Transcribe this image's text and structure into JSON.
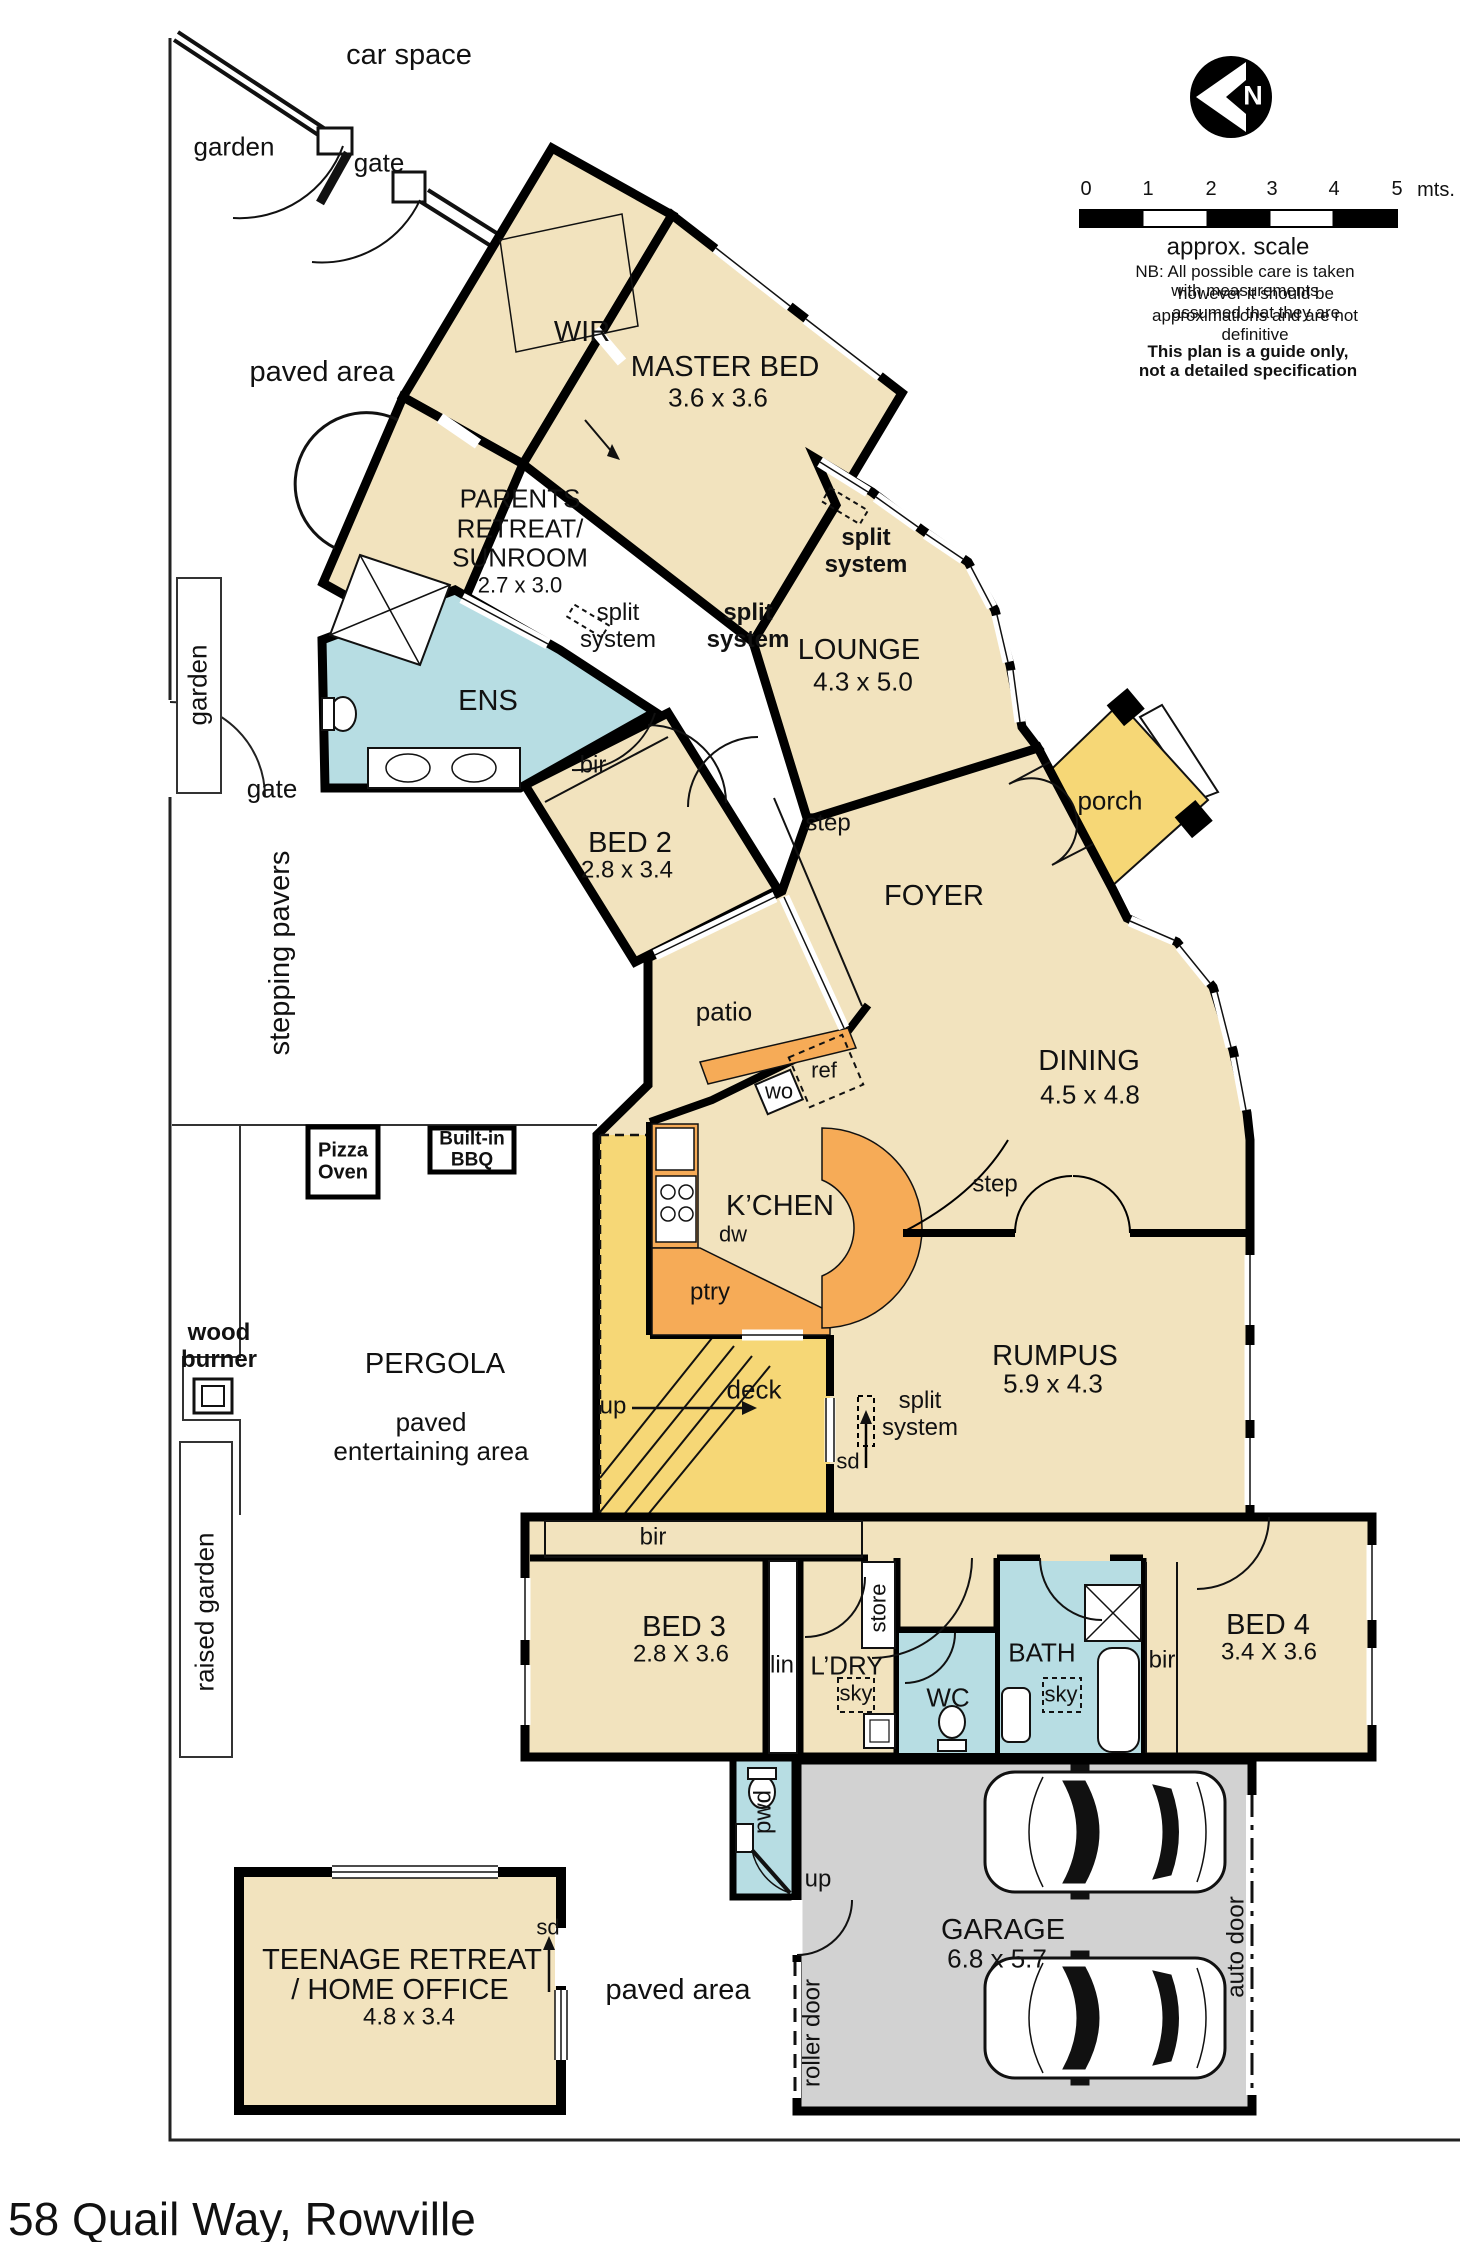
{
  "address": "58 Quail Way, Rowville",
  "compass": {
    "north": "N"
  },
  "scale": {
    "ticks": [
      "0",
      "1",
      "2",
      "3",
      "4",
      "5"
    ],
    "unit": "mts.",
    "caption": "approx. scale"
  },
  "notes": {
    "nb1": "NB:  All possible care is taken with measurements",
    "nb2": "however it should be assumed that they are",
    "nb3": "approximations and are not definitive",
    "disclaimer": "This plan is a guide only, not a detailed specification"
  },
  "site": {
    "car_space": "car space",
    "garden": "garden",
    "gate": "gate",
    "paved_area": "paved area",
    "stepping_pavers": "stepping pavers",
    "raised_garden": "raised garden",
    "wood_burner": "wood\nburner",
    "pizza_oven": "Pizza\nOven",
    "built_in_bbq": "Built-in\nBBQ",
    "pergola": "PERGOLA",
    "paved_entertaining": "paved\nentertaining area"
  },
  "rooms": {
    "wir": "WIR",
    "master": "MASTER BED",
    "master_dims": "3.6 x 3.6",
    "parents_line1": "PARENTS",
    "parents_line2": "RETREAT/",
    "parents_line3": "SUNROOM",
    "parents_dims": "2.7 x 3.0",
    "ens": "ENS",
    "bed2": "BED 2",
    "bed2_dims": "2.8 x 3.4",
    "lounge": "LOUNGE",
    "lounge_dims": "4.3 x 5.0",
    "foyer": "FOYER",
    "porch": "porch",
    "patio": "patio",
    "dining": "DINING",
    "dining_dims": "4.5 x 4.8",
    "kitchen": "K’CHEN",
    "rumpus": "RUMPUS",
    "rumpus_dims": "5.9 x 4.3",
    "deck": "deck",
    "bed3": "BED 3",
    "bed3_dims": "2.8 X 3.6",
    "ldry": "L’DRY",
    "wc": "WC",
    "bath": "BATH",
    "bed4": "BED 4",
    "bed4_dims": "3.4 X 3.6",
    "garage": "GARAGE",
    "garage_dims": "6.8 x 5.7",
    "teen_line1": "TEENAGE RETREAT",
    "teen_line2": "/ HOME OFFICE",
    "teen_dims": "4.8 x 3.4"
  },
  "features": {
    "split_system": "split\nsystem",
    "step": "step",
    "bir": "bir",
    "lin": "lin",
    "sky": "sky",
    "store": "store",
    "pwd": "pwd",
    "up": "up",
    "sd": "sd",
    "ref": "ref",
    "wo": "wo",
    "dw": "dw",
    "ptry": "ptry",
    "roller_door": "roller door",
    "auto_door": "auto door"
  }
}
